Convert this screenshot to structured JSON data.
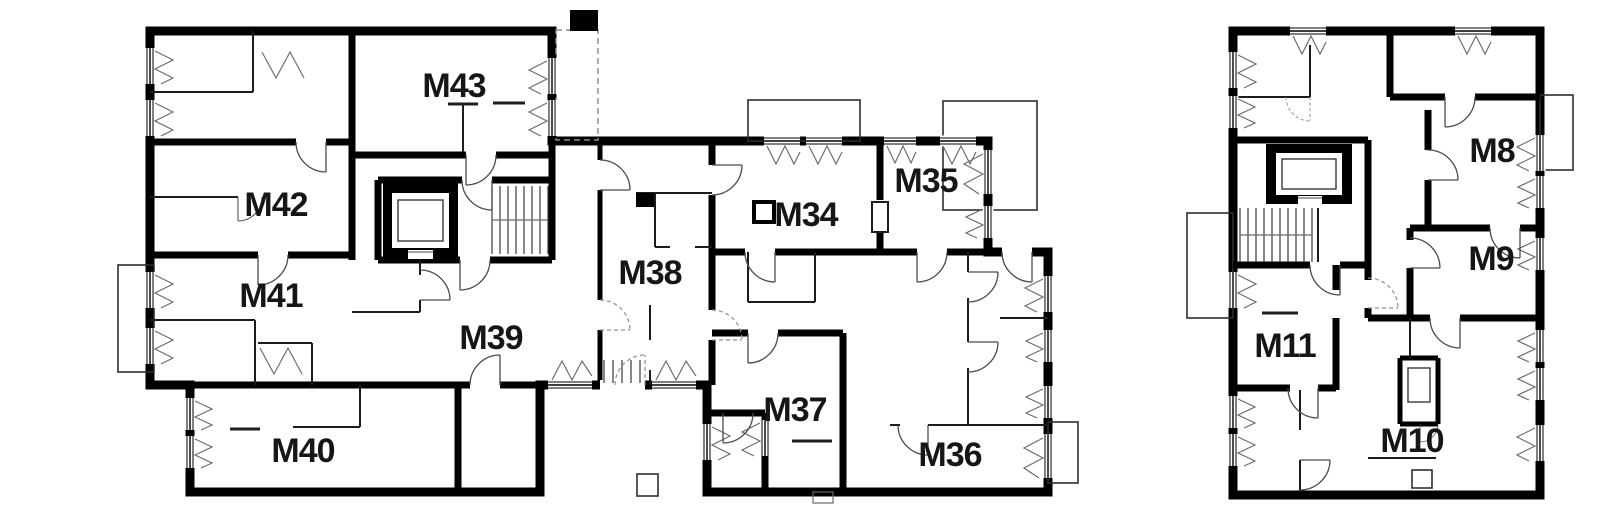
{
  "canvas": {
    "width": 1600,
    "height": 519,
    "background": "#ffffff"
  },
  "colors": {
    "wall": "#000000",
    "thin_wall": "#1c1c1c",
    "light_line": "#6b6b6b",
    "label": "#161616",
    "background": "#ffffff"
  },
  "floorplan": {
    "type": "architectural-floor-plan",
    "buildings": [
      {
        "id": "building-a",
        "unit_labels": [
          "M43",
          "M42",
          "M41",
          "M40",
          "M39",
          "M38",
          "M34",
          "M35",
          "M37",
          "M36"
        ]
      },
      {
        "id": "building-b",
        "unit_labels": [
          "M8",
          "M9",
          "M11",
          "M10"
        ]
      }
    ],
    "symbols": [
      "stairs",
      "elevator",
      "window",
      "door-swing",
      "balcony",
      "entry-steps"
    ]
  },
  "units": [
    {
      "id": "m43",
      "label": "M43"
    },
    {
      "id": "m42",
      "label": "M42"
    },
    {
      "id": "m41",
      "label": "M41"
    },
    {
      "id": "m40",
      "label": "M40"
    },
    {
      "id": "m39",
      "label": "M39"
    },
    {
      "id": "m38",
      "label": "M38"
    },
    {
      "id": "m34",
      "label": "M34"
    },
    {
      "id": "m35",
      "label": "M35"
    },
    {
      "id": "m37",
      "label": "M37"
    },
    {
      "id": "m36",
      "label": "M36"
    },
    {
      "id": "m8",
      "label": "M8"
    },
    {
      "id": "m9",
      "label": "M9"
    },
    {
      "id": "m11",
      "label": "M11"
    },
    {
      "id": "m10",
      "label": "M10"
    }
  ]
}
